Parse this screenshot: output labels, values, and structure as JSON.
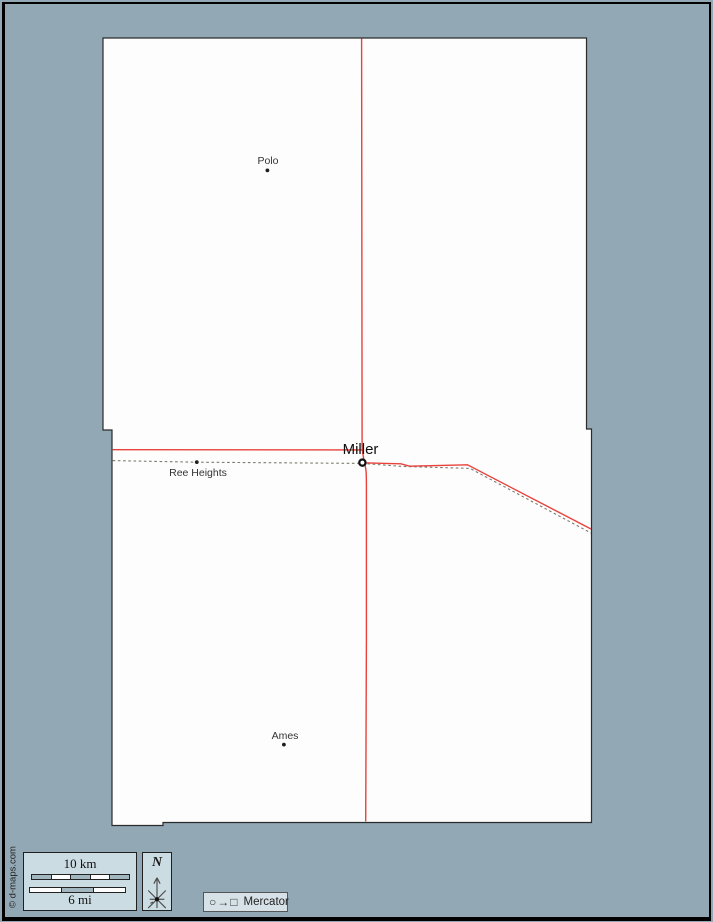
{
  "towns": [
    {
      "name": "Polo",
      "type": "town"
    },
    {
      "name": "Ree Heights",
      "type": "town"
    },
    {
      "name": "Ames",
      "type": "town"
    },
    {
      "name": "Miller",
      "type": "county-seat"
    }
  ],
  "legend": {
    "scale_km": "10 km",
    "scale_mi": "6 mi",
    "compass": "N",
    "projection_symbols": "○→□",
    "projection_name": "Mercator"
  },
  "copyright": "© d-maps.com",
  "colors": {
    "background": "#92a8b5",
    "land": "#fdfdfd",
    "road": "#e8423b",
    "railroad": "#7d796c",
    "panel": "#ccdce3",
    "frame": "#000000"
  }
}
